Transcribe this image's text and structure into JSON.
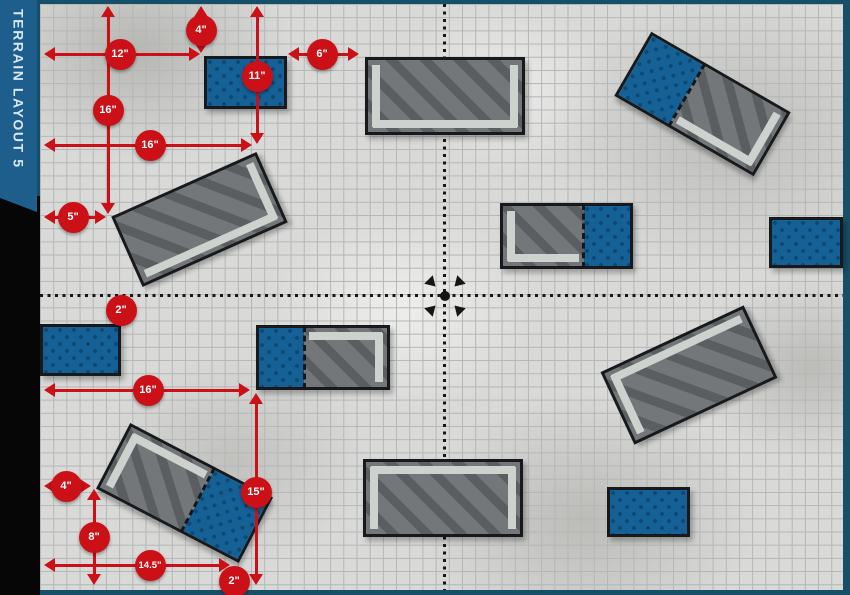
{
  "banner": {
    "title": "TERRAIN LAYOUT 5"
  },
  "colors": {
    "red": "#cc1018",
    "banner_blue": "#1e5e8d",
    "banner_text": "#d9e7f2",
    "frame_teal": "#174f68",
    "paper": "#d9d9d7",
    "grid_line": "#b3b7b7",
    "piece_gray": "#73777a",
    "piece_gray_stripe": "#5a5e61",
    "wall_light": "#cdd2cf",
    "piece_blue": "#156095",
    "piece_blue_dot": "#0c4872",
    "outline_black": "#17191c",
    "marker_black": "#151515"
  },
  "map": {
    "area": {
      "left": 40,
      "top": 4,
      "width": 803,
      "height": 586
    },
    "grid_square_px": 13.2,
    "centerlines": {
      "vertical_x": 443,
      "horizontal_y": 294
    },
    "center_marker": {
      "x": 445,
      "y": 296
    }
  },
  "pieces": [
    {
      "name": "area-blue-top-left",
      "type": "blue",
      "x": 204,
      "y": 56,
      "w": 83,
      "h": 53,
      "rot": 0
    },
    {
      "name": "ruin-gray-top-center",
      "type": "gray",
      "x": 365,
      "y": 57,
      "w": 160,
      "h": 78,
      "rot": 0,
      "walls": [
        "left",
        "bottom",
        "right"
      ]
    },
    {
      "name": "combo-ruin-top-right",
      "type": "combo",
      "x": 622,
      "y": 67,
      "w": 161,
      "h": 74,
      "rot": 30,
      "blue_side": "left",
      "blue_frac": 0.38,
      "walls": [
        "bottom",
        "right"
      ]
    },
    {
      "name": "ruin-gray-mid-left",
      "type": "gray",
      "x": 120,
      "y": 181,
      "w": 159,
      "h": 77,
      "rot": -24,
      "walls": [
        "right",
        "bottom"
      ]
    },
    {
      "name": "combo-ruin-mid-center",
      "type": "combo",
      "x": 500,
      "y": 203,
      "w": 133,
      "h": 66,
      "rot": 0,
      "blue_side": "right",
      "blue_frac": 0.36,
      "walls": [
        "left",
        "bottom"
      ]
    },
    {
      "name": "area-blue-mid-right",
      "type": "blue",
      "x": 769,
      "y": 217,
      "w": 74,
      "h": 51,
      "rot": 0
    },
    {
      "name": "area-blue-left",
      "type": "blue",
      "x": 40,
      "y": 324,
      "w": 81,
      "h": 52,
      "rot": 0
    },
    {
      "name": "combo-ruin-mid-left",
      "type": "combo",
      "x": 256,
      "y": 325,
      "w": 134,
      "h": 65,
      "rot": 0,
      "blue_side": "left",
      "blue_frac": 0.35,
      "walls": [
        "top",
        "right"
      ]
    },
    {
      "name": "ruin-gray-bottom-right",
      "type": "gray",
      "x": 610,
      "y": 335,
      "w": 158,
      "h": 80,
      "rot": -25,
      "walls": [
        "top",
        "left"
      ]
    },
    {
      "name": "combo-ruin-bottom-left",
      "type": "combo",
      "x": 104,
      "y": 456,
      "w": 161,
      "h": 74,
      "rot": 27.5,
      "blue_side": "right",
      "blue_frac": 0.4,
      "walls": [
        "top",
        "left"
      ]
    },
    {
      "name": "ruin-gray-bottom-center",
      "type": "gray",
      "x": 363,
      "y": 459,
      "w": 160,
      "h": 78,
      "rot": 0,
      "walls": [
        "top",
        "left",
        "right"
      ]
    },
    {
      "name": "area-blue-bottom-right",
      "type": "blue",
      "x": 607,
      "y": 487,
      "w": 83,
      "h": 50,
      "rot": 0
    }
  ],
  "measurements": [
    {
      "label": "4\"",
      "cx": 201,
      "cy": 30,
      "line": {
        "o": "v",
        "at": 201,
        "from": 6,
        "to": 53
      }
    },
    {
      "label": "12\"",
      "cx": 120,
      "cy": 54,
      "line": {
        "o": "h",
        "at": 54,
        "from": 44,
        "to": 200
      }
    },
    {
      "label": "11\"",
      "cx": 257,
      "cy": 76,
      "line": {
        "o": "v",
        "at": 257,
        "from": 6,
        "to": 144
      }
    },
    {
      "label": "6\"",
      "cx": 322,
      "cy": 54,
      "line": {
        "o": "h",
        "at": 54,
        "from": 288,
        "to": 359
      }
    },
    {
      "label": "16\"",
      "cx": 108,
      "cy": 110,
      "line": {
        "o": "v",
        "at": 108,
        "from": 6,
        "to": 214
      }
    },
    {
      "label": "16\"",
      "cx": 150,
      "cy": 145,
      "line": {
        "o": "h",
        "at": 145,
        "from": 44,
        "to": 252
      }
    },
    {
      "label": "5\"",
      "cx": 73,
      "cy": 217,
      "line": {
        "o": "h",
        "at": 217,
        "from": 44,
        "to": 106
      }
    },
    {
      "label": "2\"",
      "cx": 121,
      "cy": 310,
      "line": null
    },
    {
      "label": "16\"",
      "cx": 148,
      "cy": 390,
      "line": {
        "o": "h",
        "at": 390,
        "from": 44,
        "to": 250
      }
    },
    {
      "label": "15\"",
      "cx": 256,
      "cy": 492,
      "line": {
        "o": "v",
        "at": 256,
        "from": 393,
        "to": 585
      }
    },
    {
      "label": "4\"",
      "cx": 66,
      "cy": 486,
      "line": {
        "o": "h",
        "at": 486,
        "from": 44,
        "to": 91
      }
    },
    {
      "label": "8\"",
      "cx": 94,
      "cy": 537,
      "line": {
        "o": "v",
        "at": 94,
        "from": 489,
        "to": 585
      }
    },
    {
      "label": "14.5\"",
      "cx": 150,
      "cy": 565,
      "line": {
        "o": "h",
        "at": 565,
        "from": 44,
        "to": 230
      }
    },
    {
      "label": "2\"",
      "cx": 234,
      "cy": 581,
      "line": null
    }
  ]
}
